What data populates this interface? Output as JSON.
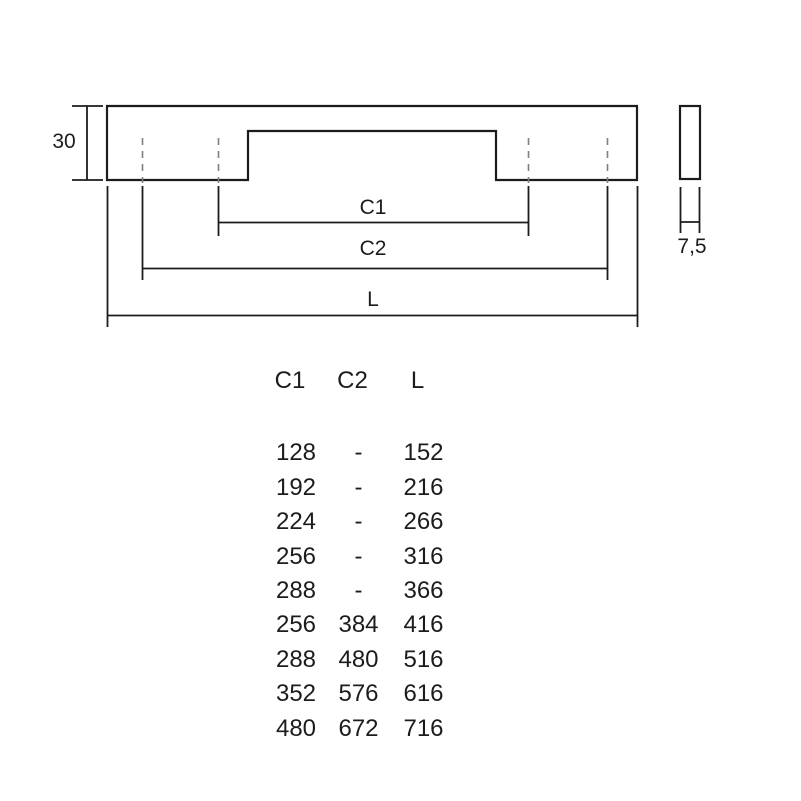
{
  "drawing": {
    "front_view": {
      "height_label": "30",
      "c1_label": "C1",
      "c2_label": "C2",
      "length_label": "L"
    },
    "side_view": {
      "thickness_label": "7,5"
    },
    "colors": {
      "background": "#ffffff",
      "line": "#1c1c1c",
      "hidden_line": "#7f7f7f",
      "text": "#1c1c1c"
    }
  },
  "table": {
    "headers": [
      "C1",
      "C2",
      "L"
    ],
    "rows": [
      [
        "128",
        "-",
        "152"
      ],
      [
        "192",
        "-",
        "216"
      ],
      [
        "224",
        "-",
        "266"
      ],
      [
        "256",
        "-",
        "316"
      ],
      [
        "288",
        "-",
        "366"
      ],
      [
        "256",
        "384",
        "416"
      ],
      [
        "288",
        "480",
        "516"
      ],
      [
        "352",
        "576",
        "616"
      ],
      [
        "480",
        "672",
        "716"
      ]
    ]
  }
}
